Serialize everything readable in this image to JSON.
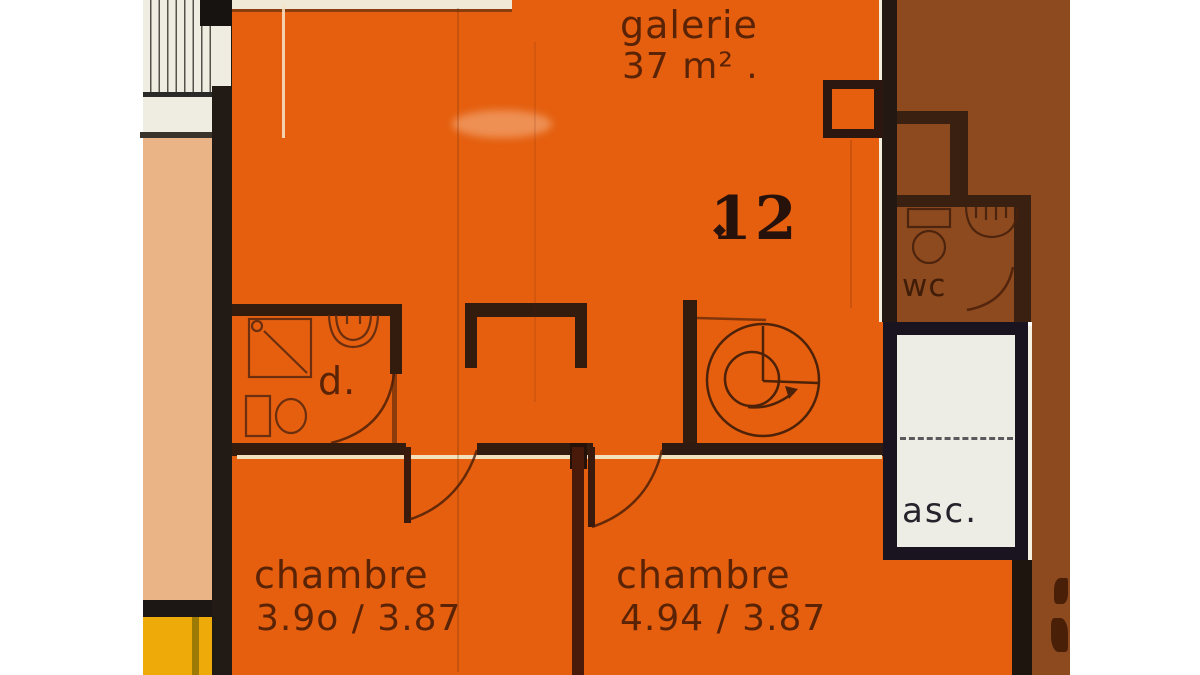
{
  "document": {
    "kind": "architectural floor plan (colored scan)",
    "unit_number": "12"
  },
  "rooms": {
    "galerie": {
      "label": "galerie",
      "area": "37 m² ."
    },
    "chambre_left": {
      "label": "chambre",
      "dimensions": "3.9o / 3.87"
    },
    "chambre_right": {
      "label": "chambre",
      "dimensions": "4.94 / 3.87"
    },
    "wc": {
      "label": "wc"
    },
    "elevator": {
      "label": "asc."
    },
    "shower_room": {
      "label": "d."
    }
  },
  "icons": {
    "spiral_staircase": "spiral-staircase-icon",
    "straight_staircase": "staircase-treads",
    "shower": "shower-icon",
    "bathroom_sink": "sink-icon",
    "bathroom_toilet": "toilet-icon",
    "wc_toilet": "wc-toilet-icon",
    "wc_sink": "wc-sink-icon",
    "door_swing": "door-arc",
    "elevator_travel": "elevator-dashed-line"
  },
  "colors": {
    "unit_orange": "#E55F0E",
    "adjacent_brown": "#8D4A1F",
    "adjacent_peach": "#EBB486",
    "adjacent_yellow": "#EDAA08",
    "wall_dark": "#221A15",
    "plan_cream": "#EFEDE2",
    "label_ink": "#5B2306",
    "stencil_ink": "#26120B"
  }
}
